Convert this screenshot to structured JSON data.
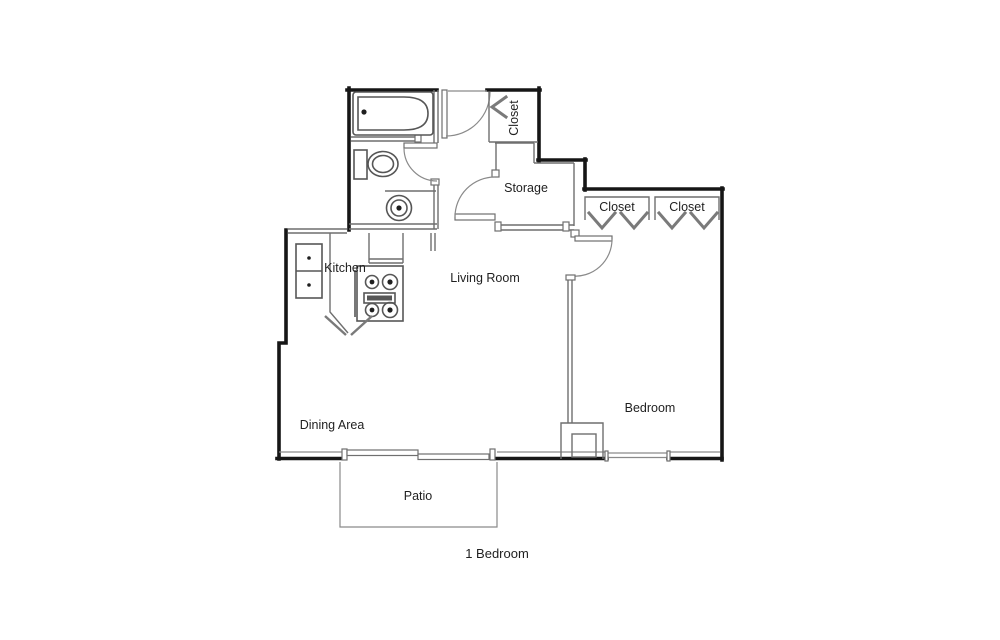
{
  "plan": {
    "caption": "1 Bedroom",
    "colors": {
      "background": "#ffffff",
      "outer_wall": "#161616",
      "interior_line": "#6f6f6f",
      "fixture_line": "#565656",
      "label_text": "#1f1f1f"
    },
    "rooms": {
      "closet_top": {
        "label": "Closet"
      },
      "storage": {
        "label": "Storage"
      },
      "closet_left": {
        "label": "Closet"
      },
      "closet_right": {
        "label": "Closet"
      },
      "kitchen": {
        "label": "Kitchen"
      },
      "living_room": {
        "label": "Living Room"
      },
      "bedroom": {
        "label": "Bedroom"
      },
      "dining_area": {
        "label": "Dining Area"
      },
      "patio": {
        "label": "Patio"
      }
    },
    "fixtures": [
      "bathtub-icon",
      "toilet-icon",
      "sink-icon",
      "kitchen-sink-icon",
      "stove-icon",
      "door-arc",
      "bifold-door-chevron",
      "sliding-door",
      "window"
    ]
  }
}
